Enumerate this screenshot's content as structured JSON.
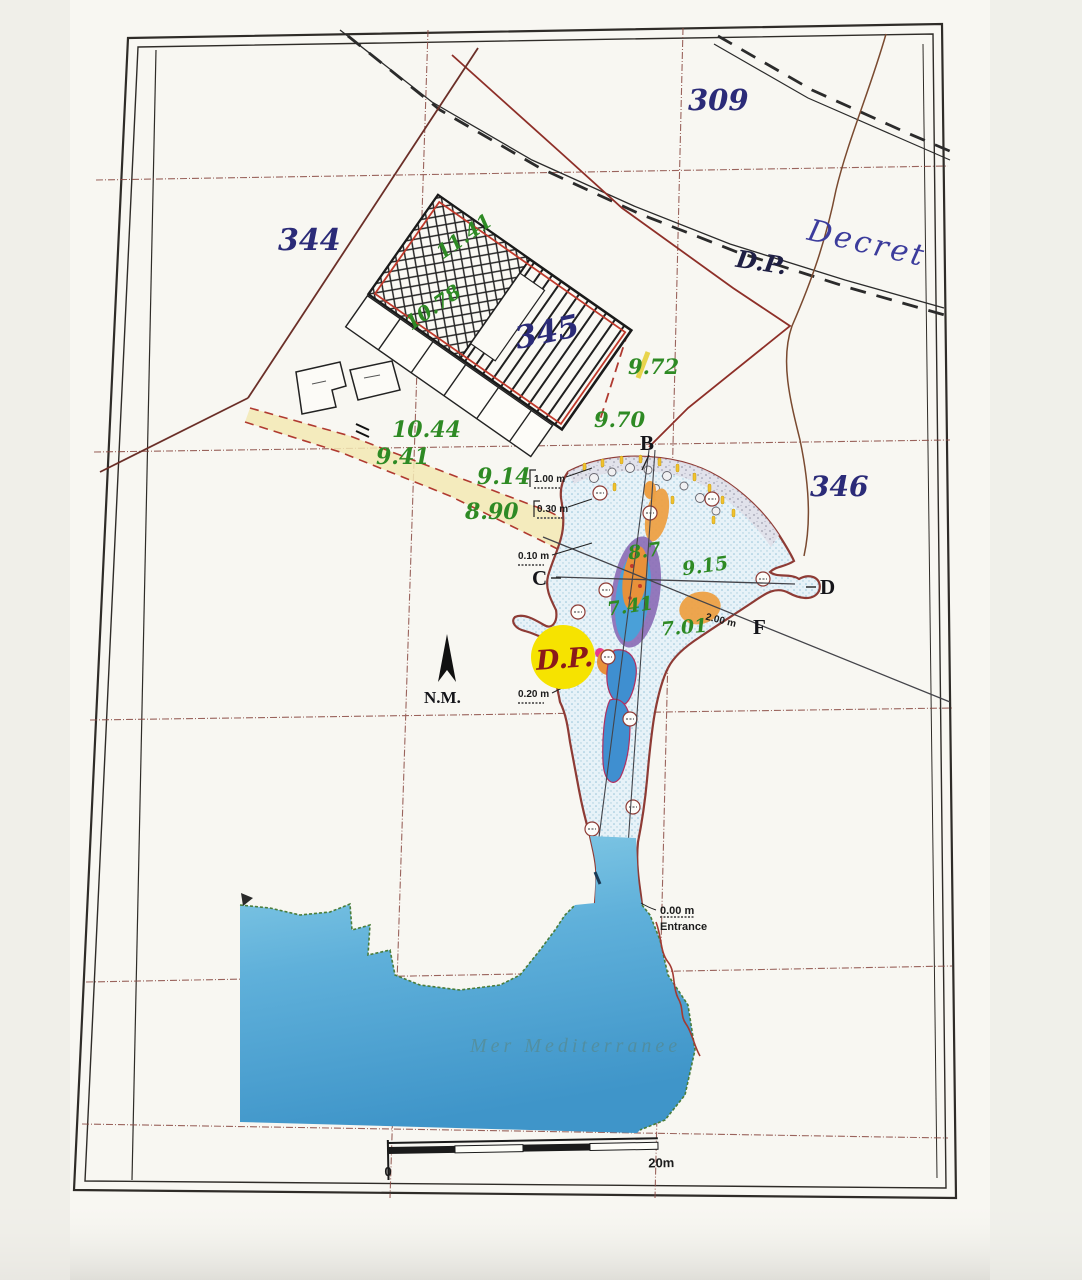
{
  "parcels": {
    "p344": "344",
    "p345": "345",
    "p309": "309",
    "p346": "346"
  },
  "roads": {
    "decret_label": "Decret",
    "dp_label": "D.P."
  },
  "dp_circle": {
    "label": "D.P."
  },
  "north": {
    "label": "N.M."
  },
  "points": {
    "b": "B",
    "c": "C",
    "d": "D",
    "f": "F"
  },
  "elevations": {
    "e1": "11.41",
    "e2": "10.78",
    "e3": "9.72",
    "e4": "9.70",
    "e5": "10.44",
    "e6": "9.41",
    "e7": "9.14",
    "e8": "8.90",
    "e9": "8.7",
    "e10": "9.15",
    "e11": "7.41",
    "e12": "7.01"
  },
  "measurements": {
    "m1": "1.00 m",
    "m2": "0.30 m",
    "m3": "0.10 m",
    "m4": "0.20 m",
    "m5": "2.00 m",
    "m6": "0.00 m",
    "entrance": "Entrance"
  },
  "sea": {
    "label": "Mer Mediterranee"
  },
  "scale_bar": {
    "start": "0",
    "end": "20m"
  },
  "colors": {
    "paper": "#f8f7f2",
    "frame": "#2f2c28",
    "grid": "#8a4a42",
    "parcel_text": "#2b2b78",
    "green_text": "#2e8a24",
    "road_text": "#3c3c9c",
    "dp_circle_fill": "#f6e300",
    "dp_circle_text": "#8a1a1a",
    "lagoon_outline": "#8e3b35",
    "sea_light": "#8cd0e8",
    "sea_deep": "#3f95c9",
    "pool_purple": "#8a6ab5",
    "pool_orange": "#e8913a",
    "pool_blue": "#3f8fd0",
    "beach_yellow": "#f0c22e"
  }
}
